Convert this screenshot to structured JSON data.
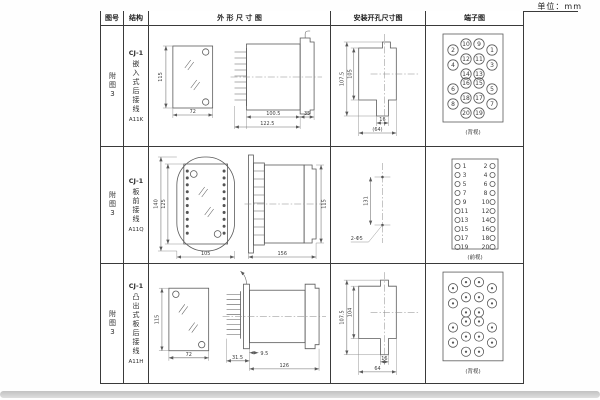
{
  "page": {
    "unit": "单位：mm"
  },
  "headers": {
    "fig": "图号",
    "structure": "结构",
    "outline": "外 形 尺 寸 图",
    "mounting": "安装开孔尺寸图",
    "terminal": "端子图"
  },
  "rows": [
    {
      "fig": "附图3",
      "model": "CJ-1",
      "mount_type": "嵌入式后接线",
      "code": "A11K",
      "outline": {
        "h": "115",
        "w": "72",
        "body": "100.5",
        "total": "122.5",
        "flange": "35"
      },
      "mounting": {
        "outer": "107.5",
        "inner": "105",
        "slot": "16",
        "width": "(64)"
      },
      "terminal": {
        "caption": "(背视)"
      }
    },
    {
      "fig": "附图3",
      "model": "CJ-1",
      "mount_type": "板前接线",
      "code": "A11Q",
      "outline": {
        "h_outer": "140",
        "h_inner": "125",
        "w": "105",
        "len": "156",
        "side_h": "115"
      },
      "mounting": {
        "span": "131",
        "holes": "2-Φ5"
      },
      "terminal": {
        "caption": "(前视)"
      }
    },
    {
      "fig": "附图3",
      "model": "CJ-1",
      "mount_type": "凸出式板后接线",
      "code": "A11H",
      "outline": {
        "h": "115",
        "w": "72",
        "pins": "31.5",
        "step": "9.5",
        "len": "126"
      },
      "mounting": {
        "outer": "107.5",
        "inner": "104",
        "slot": "16",
        "width": "64"
      },
      "terminal": {
        "caption": "(背视)"
      }
    }
  ],
  "terminal_layouts": {
    "rear_numbered": {
      "r": 5.2,
      "items": [
        {
          "x": 27,
          "y": 24,
          "n": "2"
        },
        {
          "x": 40,
          "y": 18,
          "n": "10"
        },
        {
          "x": 53,
          "y": 18,
          "n": "9"
        },
        {
          "x": 66,
          "y": 24,
          "n": "1"
        },
        {
          "x": 27,
          "y": 39,
          "n": "4"
        },
        {
          "x": 40,
          "y": 33,
          "n": "12"
        },
        {
          "x": 53,
          "y": 33,
          "n": "11"
        },
        {
          "x": 66,
          "y": 39,
          "n": "3"
        },
        {
          "x": 40,
          "y": 48,
          "n": "14"
        },
        {
          "x": 53,
          "y": 48,
          "n": "13"
        },
        {
          "x": 27,
          "y": 63,
          "n": "6"
        },
        {
          "x": 40,
          "y": 57,
          "n": "16"
        },
        {
          "x": 53,
          "y": 57,
          "n": "15"
        },
        {
          "x": 66,
          "y": 63,
          "n": "5"
        },
        {
          "x": 27,
          "y": 78,
          "n": "8"
        },
        {
          "x": 40,
          "y": 72,
          "n": "18"
        },
        {
          "x": 53,
          "y": 72,
          "n": "17"
        },
        {
          "x": 66,
          "y": 78,
          "n": "7"
        },
        {
          "x": 40,
          "y": 87,
          "n": "20"
        },
        {
          "x": 53,
          "y": 87,
          "n": "19"
        }
      ]
    },
    "rear_dots": {
      "r": 4.6,
      "dot": true,
      "items_ref": "rear_numbered"
    },
    "front_pairs": {
      "pairs": true,
      "r": 2.6,
      "y0": 19,
      "dy": 9,
      "cx_left": 31.5,
      "cx_right": 66.5,
      "x_left": 38.5,
      "x_right": 59.5,
      "left": [
        "1",
        "3",
        "5",
        "7",
        "9",
        "11",
        "13",
        "15",
        "17",
        "19"
      ],
      "right": [
        "2",
        "4",
        "6",
        "8",
        "10",
        "12",
        "14",
        "16",
        "18",
        "20"
      ]
    }
  }
}
